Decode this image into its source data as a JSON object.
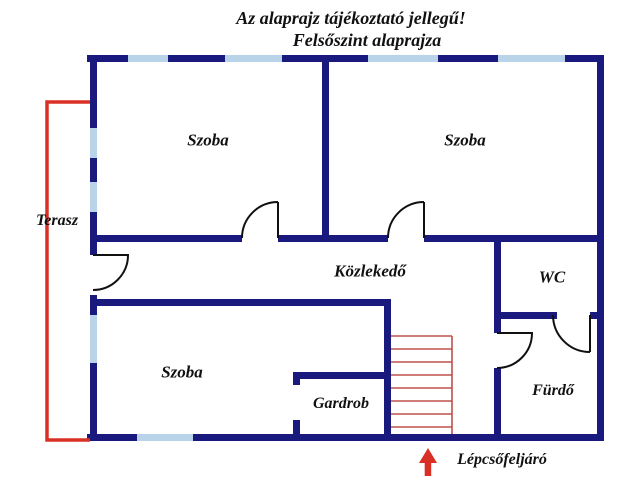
{
  "title": {
    "line1": "Az alaprajz tájékoztató jellegű!",
    "line2": "Felsőszint alaprajza"
  },
  "rooms": {
    "szoba_top_left": "Szoba",
    "szoba_top_right": "Szoba",
    "szoba_bottom_left": "Szoba",
    "terasz": "Terasz",
    "kozlekedo": "Közlekedő",
    "wc": "WC",
    "gardrob": "Gardrob",
    "furdo": "Fürdő"
  },
  "annotations": {
    "staircase_label": "Lépcsőfeljáró"
  },
  "colors": {
    "wall-color": "#1a1a7e",
    "window-color": "#b9d3e8",
    "terrace-color": "#d93025",
    "stair-color": "#c0504d",
    "arrow-color": "#d93025"
  }
}
